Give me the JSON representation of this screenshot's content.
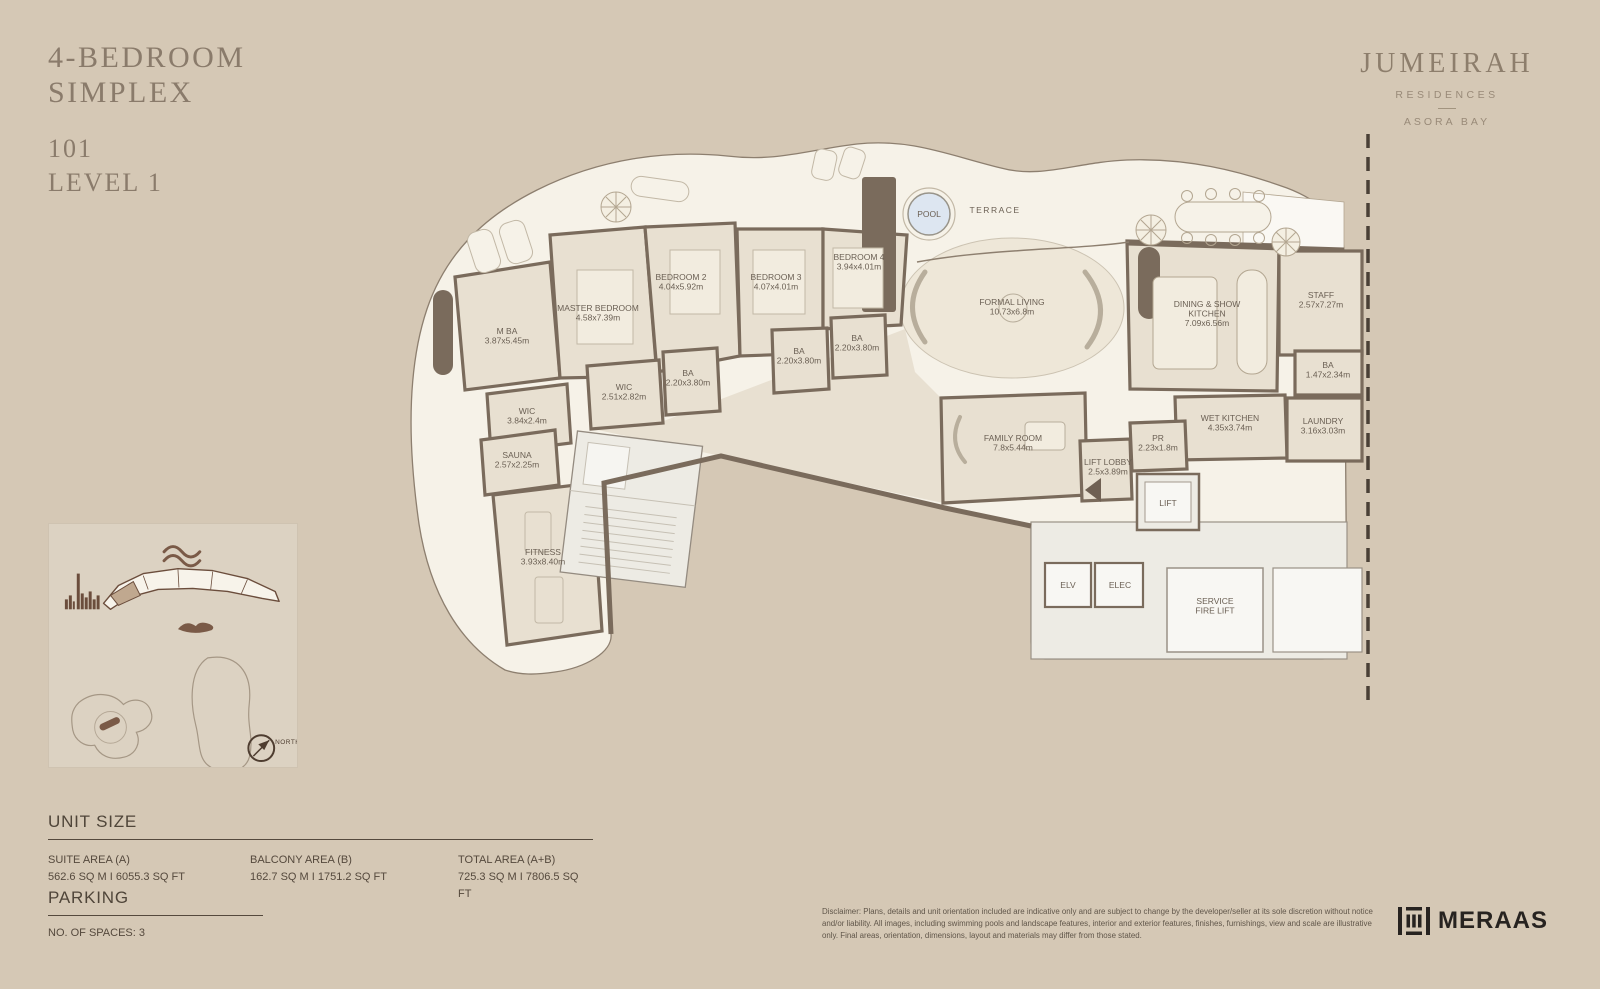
{
  "title": {
    "line1": "4-BEDROOM",
    "line2": "SIMPLEX",
    "unit": "101",
    "level": "LEVEL 1"
  },
  "brand": {
    "name": "JUMEIRAH",
    "residences": "RESIDENCES",
    "location": "ASORA BAY"
  },
  "floorplan": {
    "labels": [
      {
        "id": "m-ba",
        "lines": [
          "M BA"
        ],
        "dims": "3.87x5.45m",
        "x": 122,
        "y": 212
      },
      {
        "id": "master-bedroom",
        "lines": [
          "MASTER BEDROOM"
        ],
        "dims": "4.58x7.39m",
        "x": 213,
        "y": 189
      },
      {
        "id": "bedroom-2",
        "lines": [
          "BEDROOM 2"
        ],
        "dims": "4.04x5.92m",
        "x": 296,
        "y": 158
      },
      {
        "id": "bedroom-3",
        "lines": [
          "BEDROOM 3"
        ],
        "dims": "4.07x4.01m",
        "x": 391,
        "y": 158
      },
      {
        "id": "bedroom-4",
        "lines": [
          "BEDROOM 4"
        ],
        "dims": "3.94x4.01m",
        "x": 474,
        "y": 138
      },
      {
        "id": "wic-master",
        "lines": [
          "WIC"
        ],
        "dims": "2.51x2.82m",
        "x": 239,
        "y": 268
      },
      {
        "id": "ba-bedroom2",
        "lines": [
          "BA"
        ],
        "dims": "2.20x3.80m",
        "x": 303,
        "y": 254
      },
      {
        "id": "ba-bedroom3",
        "lines": [
          "BA"
        ],
        "dims": "2.20x3.80m",
        "x": 414,
        "y": 232
      },
      {
        "id": "ba-bedroom4",
        "lines": [
          "BA"
        ],
        "dims": "2.20x3.80m",
        "x": 472,
        "y": 219
      },
      {
        "id": "wic-2",
        "lines": [
          "WIC"
        ],
        "dims": "3.84x2.4m",
        "x": 142,
        "y": 292
      },
      {
        "id": "sauna",
        "lines": [
          "SAUNA"
        ],
        "dims": "2.57x2.25m",
        "x": 132,
        "y": 336
      },
      {
        "id": "fitness",
        "lines": [
          "FITNESS"
        ],
        "dims": "3.93x8.40m",
        "x": 158,
        "y": 433
      },
      {
        "id": "pool",
        "lines": [
          "POOL"
        ],
        "x": 544,
        "y": 95,
        "size": 9
      },
      {
        "id": "terrace",
        "lines": [
          "TERRACE"
        ],
        "x": 610,
        "y": 91,
        "size": 10,
        "ls": 1.5
      },
      {
        "id": "formal-living",
        "lines": [
          "FORMAL LIVING"
        ],
        "dims": "10.73x6.8m",
        "x": 627,
        "y": 183,
        "size": 10
      },
      {
        "id": "family-room",
        "lines": [
          "FAMILY ROOM"
        ],
        "dims": "7.8x5.44m",
        "x": 628,
        "y": 319,
        "size": 10
      },
      {
        "id": "dining-show-kitchen",
        "lines": [
          "DINING & SHOW",
          "KITCHEN"
        ],
        "dims": "7.09x6.56m",
        "x": 822,
        "y": 185,
        "size": 10
      },
      {
        "id": "staff",
        "lines": [
          "STAFF"
        ],
        "dims": "2.57x7.27m",
        "x": 936,
        "y": 176
      },
      {
        "id": "ba-staff",
        "lines": [
          "BA"
        ],
        "dims": "1.47x2.34m",
        "x": 943,
        "y": 246
      },
      {
        "id": "wet-kitchen",
        "lines": [
          "WET KITCHEN"
        ],
        "dims": "4.35x3.74m",
        "x": 845,
        "y": 299
      },
      {
        "id": "laundry",
        "lines": [
          "LAUNDRY"
        ],
        "dims": "3.16x3.03m",
        "x": 938,
        "y": 302
      },
      {
        "id": "pr",
        "lines": [
          "PR"
        ],
        "dims": "2.23x1.8m",
        "x": 773,
        "y": 319
      },
      {
        "id": "lift-lobby",
        "lines": [
          "LIFT LOBBY"
        ],
        "dims": "2.5x3.89m",
        "x": 723,
        "y": 343
      },
      {
        "id": "lift",
        "lines": [
          "LIFT"
        ],
        "x": 783,
        "y": 384
      },
      {
        "id": "elv",
        "lines": [
          "ELV"
        ],
        "x": 683,
        "y": 466,
        "size": 7.5
      },
      {
        "id": "elec",
        "lines": [
          "ELEC"
        ],
        "x": 735,
        "y": 466,
        "size": 7.5
      },
      {
        "id": "service-fire-lift",
        "lines": [
          "SERVICE",
          "FIRE LIFT"
        ],
        "x": 830,
        "y": 482
      }
    ]
  },
  "sitemap": {
    "north": "NORTH"
  },
  "unit_size": {
    "heading": "UNIT SIZE",
    "columns": [
      {
        "label": "SUITE AREA (A)",
        "value": "562.6 SQ M I 6055.3 SQ FT"
      },
      {
        "label": "BALCONY AREA (B)",
        "value": "162.7 SQ M I 1751.2 SQ FT"
      },
      {
        "label": "TOTAL AREA (A+B)",
        "value": "725.3 SQ M I 7806.5 SQ FT"
      }
    ]
  },
  "parking": {
    "heading": "PARKING",
    "value": "NO. OF SPACES: 3"
  },
  "footer": {
    "disclaimer": "Disclaimer: Plans, details and unit orientation included are indicative only and are subject to change by the developer/seller at its sole discretion without notice and/or liability. All images, including swimming pools and landscape features, interior and exterior features, finishes, furnishings, view and scale are illustrative only. Final areas, orientation, dimensions, layout and materials may differ from those stated.",
    "developer": "MERAAS"
  }
}
